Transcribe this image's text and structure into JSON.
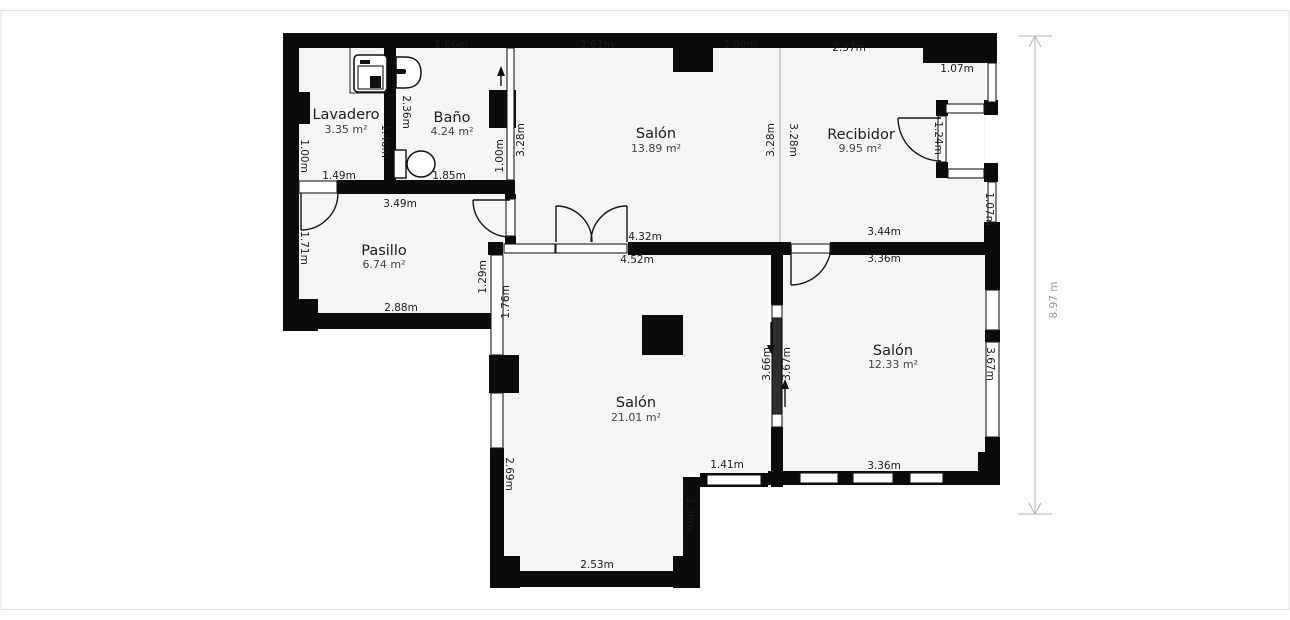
{
  "colors": {
    "wall": "#0b0b0b",
    "room_fill": "#f5f5f5",
    "thin_wall_fill": "#2e2e2e",
    "divider": "#cfcfcf",
    "dimension_line": "#b5b5b5",
    "dimension_text": "#999999",
    "text": "#1c1c1c",
    "area_text": "#444444",
    "page_border": "#e2e2e2"
  },
  "plan": {
    "rooms": {
      "lavadero": {
        "name": "Lavadero",
        "area": "3.35 m²"
      },
      "bano": {
        "name": "Baño",
        "area": "4.24 m²"
      },
      "salon_top": {
        "name": "Salón",
        "area": "13.89 m²"
      },
      "recibidor": {
        "name": "Recibidor",
        "area": "9.95 m²"
      },
      "pasillo": {
        "name": "Pasillo",
        "area": "6.74 m²"
      },
      "salon_center": {
        "name": "Salón",
        "area": "21.01 m²"
      },
      "salon_right": {
        "name": "Salón",
        "area": "12.33 m²"
      }
    },
    "dims": {
      "d186": "1.86m",
      "d261": "2.61m",
      "d108": "1.08m",
      "d237": "2.37m",
      "d107a": "1.07m",
      "d149": "1.49m",
      "d185": "1.85m",
      "d349": "3.49m",
      "d288": "2.88m",
      "d432": "4.32m",
      "d452": "4.52m",
      "d344": "3.44m",
      "d336a": "3.36m",
      "d336b": "3.36m",
      "d141": "1.41m",
      "d253": "2.53m",
      "d100a": "1.00m",
      "d236": "2.36m",
      "d146": "1.46m",
      "d100b": "1.00m",
      "d328a": "3.28m",
      "d328b": "3.28m",
      "d328c": "3.28m",
      "d124": "1.24m",
      "d107b": "1.07m",
      "d171": "1.71m",
      "d129": "1.29m",
      "d176": "1.76m",
      "d269": "2.69m",
      "d138": "1.38m",
      "d366": "3.66m",
      "d367a": "3.67m",
      "d367b": "3.67m",
      "d897": "8.97 m"
    },
    "icons": {
      "washing_machine": "washing-machine-icon",
      "sink": "sink-icon",
      "toilet": "toilet-icon",
      "entry_arrow": "up-arrow-icon",
      "flow_down": "down-arrow-icon",
      "flow_up": "up-arrow-icon"
    }
  }
}
